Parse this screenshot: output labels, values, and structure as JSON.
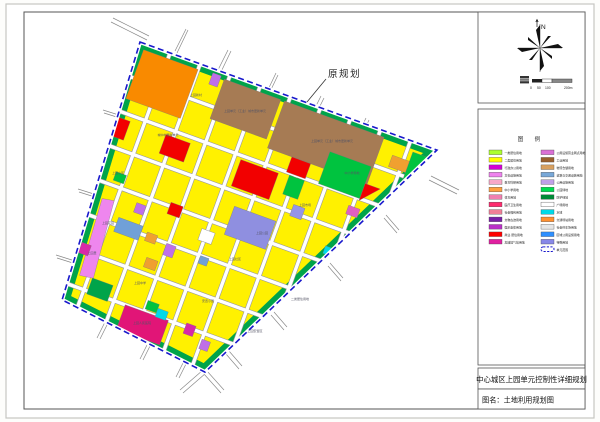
{
  "page": {
    "background": "#fdfdfb",
    "frame_color": "#555555"
  },
  "annotation": {
    "label": "原规划"
  },
  "north": {
    "label": "N"
  },
  "scale_bar": {
    "ticks": [
      "0",
      "50",
      "100"
    ],
    "end_label": "200m"
  },
  "legend": {
    "title": "图  例",
    "left": [
      {
        "label": "一类居住用地",
        "color": "#ADFF2F"
      },
      {
        "label": "二类居住用地",
        "color": "#FFFF00"
      },
      {
        "label": "行政办公用地",
        "color": "#D400D4"
      },
      {
        "label": "文化设施用地",
        "color": "#EE82EE"
      },
      {
        "label": "教育科研用地",
        "color": "#F7A8C8"
      },
      {
        "label": "中小学用地",
        "color": "#FFA040"
      },
      {
        "label": "体育用地",
        "color": "#F080B0"
      },
      {
        "label": "医疗卫生用地",
        "color": "#FF2A6E"
      },
      {
        "label": "社会福利用地",
        "color": "#F08098"
      },
      {
        "label": "文物古迹用地",
        "color": "#7820A8"
      },
      {
        "label": "娱乐康体用地",
        "color": "#BA30C8"
      },
      {
        "label": "商业·居住用地",
        "color": "#FF0000"
      },
      {
        "label": "加油加气站用地",
        "color": "#E020A0"
      }
    ],
    "right": [
      {
        "label": "公用设施营业网点用地",
        "color": "#DA70D6"
      },
      {
        "label": "工业用地",
        "color": "#99602E"
      },
      {
        "label": "物流仓储用地",
        "color": "#D8A060"
      },
      {
        "label": "道路与交通设施用地",
        "color": "#78A8D8"
      },
      {
        "label": "公用设施用地",
        "color": "#C0A0E8"
      },
      {
        "label": "公园绿地",
        "color": "#00DC50"
      },
      {
        "label": "防护绿地",
        "color": "#008A36"
      },
      {
        "label": "广场用地",
        "color": "#FFFFFF"
      },
      {
        "label": "水域",
        "color": "#00D9E8"
      },
      {
        "label": "交通场站用地",
        "color": "#FF9030"
      },
      {
        "label": "社会停车场用地",
        "color": "#E6E6E6"
      },
      {
        "label": "区域公用设施用地",
        "color": "#2E8FFF"
      },
      {
        "label": "特殊用地",
        "color": "#8888E8"
      },
      {
        "label": "单元范围",
        "color": "boundary"
      }
    ]
  },
  "title_block": {
    "line1": "中心城区上园单元控制性详细规划",
    "line2": "图名：土地利用规划图"
  },
  "map": {
    "boundary_color": "#1818CC",
    "labels": [
      {
        "x": 245,
        "y": 112,
        "text": "上园单元（工业）城市更新单元"
      },
      {
        "x": 332,
        "y": 142,
        "text": "上园单元（工业）城市更新单元"
      },
      {
        "x": 196,
        "y": 96,
        "text": "上园新村"
      },
      {
        "x": 168,
        "y": 136,
        "text": "城中村更新单元"
      },
      {
        "x": 118,
        "y": 174,
        "text": "上园小区"
      },
      {
        "x": 108,
        "y": 224,
        "text": "上园花园"
      },
      {
        "x": 92,
        "y": 254,
        "text": "上园里"
      },
      {
        "x": 140,
        "y": 284,
        "text": "上园中学"
      },
      {
        "x": 142,
        "y": 324,
        "text": "上园人民医院"
      },
      {
        "x": 208,
        "y": 302,
        "text": "安置小区"
      },
      {
        "x": 235,
        "y": 260,
        "text": "上园社区"
      },
      {
        "x": 262,
        "y": 234,
        "text": "上园公园"
      },
      {
        "x": 305,
        "y": 206,
        "text": "上园市场"
      },
      {
        "x": 352,
        "y": 174,
        "text": "中小学用地"
      },
      {
        "x": 300,
        "y": 300,
        "text": "二类居住用地"
      },
      {
        "x": 255,
        "y": 332,
        "text": "上园安置区"
      }
    ]
  }
}
